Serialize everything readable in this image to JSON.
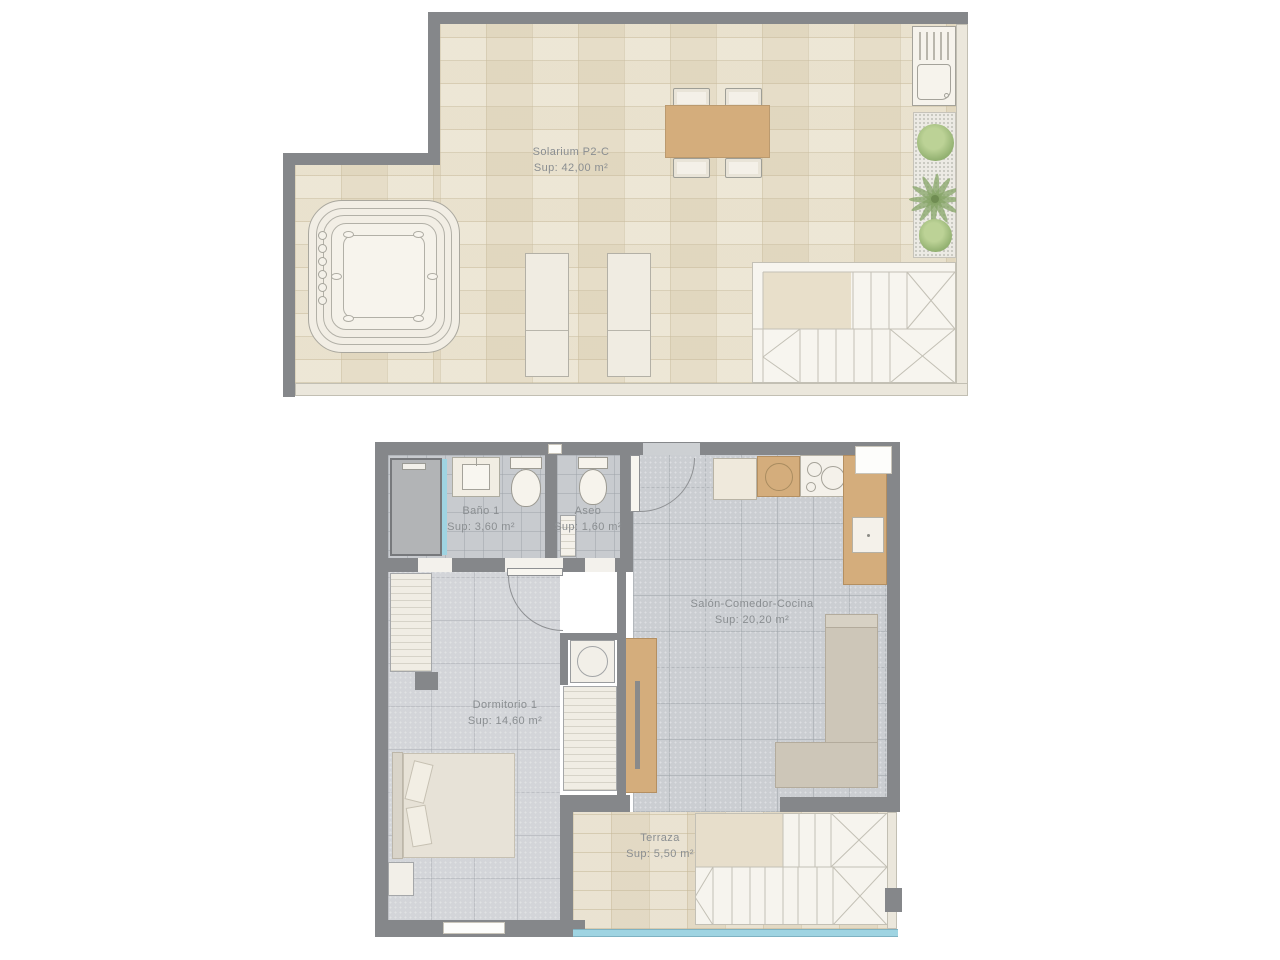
{
  "plan_type": "residential floor plan, two levels",
  "solarium": {
    "title": "Solarium P2-C",
    "area": "Sup: 42,00 m²"
  },
  "rooms": {
    "bano": {
      "title": "Baño 1",
      "area": "Sup: 3,60 m²"
    },
    "aseo": {
      "title": "Aseo",
      "area": "Sup: 1,60 m²"
    },
    "salon": {
      "title": "Salón-Comedor-Cocina",
      "area": "Sup: 20,20 m²"
    },
    "dormitorio": {
      "title": "Dormitorio 1",
      "area": "Sup: 14,60 m²"
    },
    "terraza": {
      "title": "Terraza",
      "area": "Sup: 5,50 m²"
    }
  },
  "colors": {
    "wall": "#85878a",
    "beige_tile": "#e8dfc9",
    "gray_tile": "#cbced2",
    "wood": "#d4ad7c",
    "glass": "#9fd4e2",
    "plant": "#94b272",
    "label_text": "#8a8e91"
  }
}
